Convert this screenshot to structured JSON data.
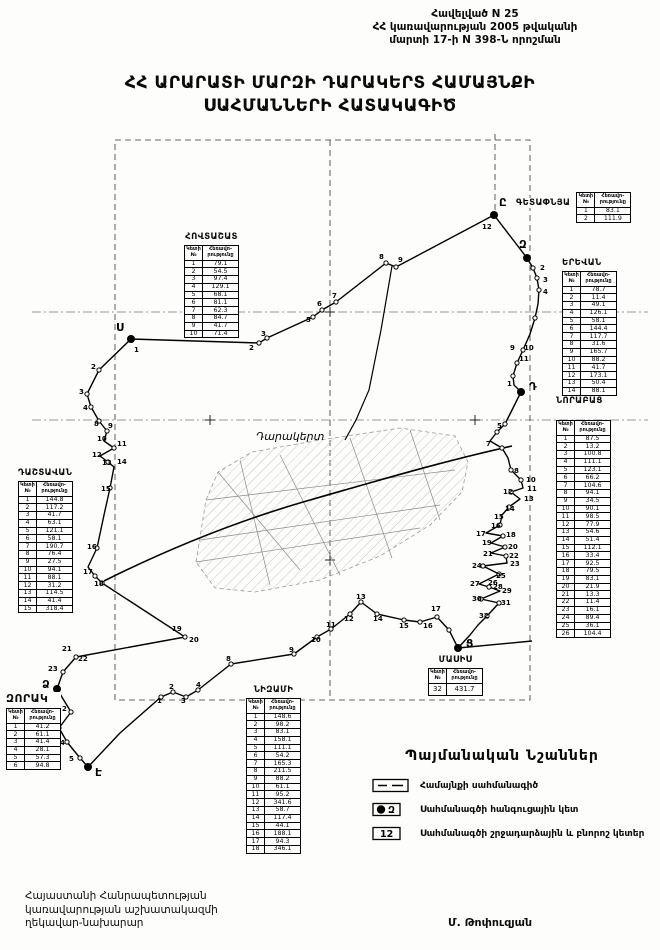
{
  "header": {
    "line1": "Հավելված N 25",
    "line2": "ՀՀ կառավարության 2005 թվականի",
    "line3": "մարտի 17-ի N 398-Ն որոշման"
  },
  "title": {
    "line1": "ՀՀ ԱՐԱՐԱՏԻ ՄԱՐԶԻ ԴԱՐԱԿԵՐՏ ՀԱՄԱՅՆՔԻ",
    "line2": "ՍԱՀՄԱՆՆԵՐԻ ՀԱՏԱԿԱԳԻԾ"
  },
  "map": {
    "settlement_label": "Դարակերտ",
    "junctions": [
      {
        "t": "Ս",
        "x": 131,
        "y": 339,
        "lx": 116,
        "ly": 331
      },
      {
        "t": "Ը",
        "x": 494,
        "y": 215,
        "lx": 499,
        "ly": 206
      },
      {
        "t": "Զ",
        "x": 527,
        "y": 258,
        "lx": 519,
        "ly": 248
      },
      {
        "t": "Դ",
        "x": 521,
        "y": 392,
        "lx": 529,
        "ly": 390
      },
      {
        "t": "Ց",
        "x": 458,
        "y": 648,
        "lx": 466,
        "ly": 647
      },
      {
        "t": "Ձ",
        "x": 57,
        "y": 689,
        "lx": 42,
        "ly": 688
      },
      {
        "t": "Է",
        "x": 88,
        "y": 767,
        "lx": 95,
        "ly": 776
      }
    ],
    "point_labels": [
      {
        "t": "2",
        "x": 249,
        "y": 350
      },
      {
        "t": "3",
        "x": 261,
        "y": 336
      },
      {
        "t": "5",
        "x": 306,
        "y": 322
      },
      {
        "t": "6",
        "x": 317,
        "y": 306
      },
      {
        "t": "7",
        "x": 332,
        "y": 298
      },
      {
        "t": "8",
        "x": 379,
        "y": 259
      },
      {
        "t": "9",
        "x": 398,
        "y": 262
      },
      {
        "t": "12",
        "x": 482,
        "y": 229
      },
      {
        "t": "2",
        "x": 540,
        "y": 270
      },
      {
        "t": "3",
        "x": 543,
        "y": 282
      },
      {
        "t": "4",
        "x": 543,
        "y": 294
      },
      {
        "t": "9",
        "x": 510,
        "y": 350
      },
      {
        "t": "10",
        "x": 524,
        "y": 350
      },
      {
        "t": "11",
        "x": 519,
        "y": 361
      },
      {
        "t": "1",
        "x": 507,
        "y": 386
      },
      {
        "t": "5",
        "x": 497,
        "y": 428
      },
      {
        "t": "7",
        "x": 486,
        "y": 446
      },
      {
        "t": "8",
        "x": 514,
        "y": 473
      },
      {
        "t": "10",
        "x": 526,
        "y": 482
      },
      {
        "t": "11",
        "x": 527,
        "y": 491
      },
      {
        "t": "12",
        "x": 503,
        "y": 494
      },
      {
        "t": "13",
        "x": 524,
        "y": 501
      },
      {
        "t": "14",
        "x": 505,
        "y": 511
      },
      {
        "t": "15",
        "x": 494,
        "y": 519
      },
      {
        "t": "16",
        "x": 491,
        "y": 528
      },
      {
        "t": "17",
        "x": 476,
        "y": 536
      },
      {
        "t": "18",
        "x": 506,
        "y": 537
      },
      {
        "t": "19",
        "x": 482,
        "y": 545
      },
      {
        "t": "20",
        "x": 508,
        "y": 549
      },
      {
        "t": "21",
        "x": 483,
        "y": 556
      },
      {
        "t": "22",
        "x": 509,
        "y": 558
      },
      {
        "t": "23",
        "x": 510,
        "y": 566
      },
      {
        "t": "24",
        "x": 472,
        "y": 568
      },
      {
        "t": "25",
        "x": 496,
        "y": 578
      },
      {
        "t": "26",
        "x": 488,
        "y": 585
      },
      {
        "t": "27",
        "x": 470,
        "y": 586
      },
      {
        "t": "28",
        "x": 493,
        "y": 589
      },
      {
        "t": "29",
        "x": 502,
        "y": 593
      },
      {
        "t": "30",
        "x": 472,
        "y": 601
      },
      {
        "t": "31",
        "x": 501,
        "y": 605
      },
      {
        "t": "32",
        "x": 479,
        "y": 618
      },
      {
        "t": "17",
        "x": 431,
        "y": 611
      },
      {
        "t": "16",
        "x": 423,
        "y": 628
      },
      {
        "t": "15",
        "x": 399,
        "y": 628
      },
      {
        "t": "14",
        "x": 373,
        "y": 621
      },
      {
        "t": "13",
        "x": 356,
        "y": 599
      },
      {
        "t": "12",
        "x": 344,
        "y": 621
      },
      {
        "t": "11",
        "x": 326,
        "y": 627
      },
      {
        "t": "10",
        "x": 311,
        "y": 642
      },
      {
        "t": "9",
        "x": 289,
        "y": 652
      },
      {
        "t": "8",
        "x": 226,
        "y": 661
      },
      {
        "t": "4",
        "x": 196,
        "y": 687
      },
      {
        "t": "3",
        "x": 181,
        "y": 703
      },
      {
        "t": "2",
        "x": 169,
        "y": 689
      },
      {
        "t": "1",
        "x": 157,
        "y": 703
      },
      {
        "t": "2",
        "x": 62,
        "y": 711
      },
      {
        "t": "3",
        "x": 51,
        "y": 728
      },
      {
        "t": "4",
        "x": 60,
        "y": 745
      },
      {
        "t": "5",
        "x": 69,
        "y": 761
      },
      {
        "t": "1",
        "x": 134,
        "y": 352
      },
      {
        "t": "2",
        "x": 91,
        "y": 369
      },
      {
        "t": "3",
        "x": 79,
        "y": 394
      },
      {
        "t": "4",
        "x": 83,
        "y": 410
      },
      {
        "t": "8",
        "x": 94,
        "y": 426
      },
      {
        "t": "9",
        "x": 108,
        "y": 428
      },
      {
        "t": "10",
        "x": 97,
        "y": 441
      },
      {
        "t": "11",
        "x": 117,
        "y": 446
      },
      {
        "t": "12",
        "x": 92,
        "y": 457
      },
      {
        "t": "13",
        "x": 102,
        "y": 465
      },
      {
        "t": "14",
        "x": 117,
        "y": 464
      },
      {
        "t": "15",
        "x": 101,
        "y": 491
      },
      {
        "t": "16",
        "x": 87,
        "y": 549
      },
      {
        "t": "17",
        "x": 83,
        "y": 574
      },
      {
        "t": "18",
        "x": 94,
        "y": 586
      },
      {
        "t": "19",
        "x": 172,
        "y": 631
      },
      {
        "t": "20",
        "x": 189,
        "y": 642
      },
      {
        "t": "21",
        "x": 62,
        "y": 651
      },
      {
        "t": "22",
        "x": 78,
        "y": 661
      },
      {
        "t": "23",
        "x": 48,
        "y": 671
      }
    ],
    "dots": [
      [
        259,
        343
      ],
      [
        267,
        338
      ],
      [
        313,
        317
      ],
      [
        322,
        310
      ],
      [
        336,
        302
      ],
      [
        386,
        263
      ],
      [
        396,
        267
      ],
      [
        533,
        268
      ],
      [
        537,
        278
      ],
      [
        539,
        290
      ],
      [
        535,
        318
      ],
      [
        523,
        350
      ],
      [
        517,
        363
      ],
      [
        513,
        376
      ],
      [
        505,
        424
      ],
      [
        497,
        432
      ],
      [
        502,
        448
      ],
      [
        511,
        470
      ],
      [
        521,
        480
      ],
      [
        511,
        492
      ],
      [
        509,
        507
      ],
      [
        500,
        525
      ],
      [
        503,
        536
      ],
      [
        505,
        547
      ],
      [
        506,
        556
      ],
      [
        483,
        566
      ],
      [
        499,
        574
      ],
      [
        489,
        587
      ],
      [
        481,
        599
      ],
      [
        499,
        603
      ],
      [
        487,
        616
      ],
      [
        449,
        630
      ],
      [
        437,
        617
      ],
      [
        420,
        622
      ],
      [
        404,
        620
      ],
      [
        377,
        614
      ],
      [
        361,
        602
      ],
      [
        350,
        614
      ],
      [
        331,
        629
      ],
      [
        317,
        637
      ],
      [
        294,
        654
      ],
      [
        231,
        664
      ],
      [
        198,
        690
      ],
      [
        186,
        697
      ],
      [
        173,
        692
      ],
      [
        161,
        697
      ],
      [
        80,
        758
      ],
      [
        67,
        742
      ],
      [
        59,
        728
      ],
      [
        71,
        712
      ],
      [
        99,
        370
      ],
      [
        87,
        394
      ],
      [
        91,
        407
      ],
      [
        99,
        421
      ],
      [
        107,
        431
      ],
      [
        114,
        448
      ],
      [
        108,
        462
      ],
      [
        110,
        488
      ],
      [
        97,
        548
      ],
      [
        95,
        576
      ],
      [
        102,
        583
      ],
      [
        185,
        637
      ],
      [
        76,
        657
      ],
      [
        63,
        672
      ]
    ]
  },
  "tables": {
    "hovtashat": {
      "caption": "ՀՈՎՏԱՇԱՏ",
      "col1": "Կետի №",
      "col2": "Հեռավո-րությունը",
      "rows": [
        [
          "1",
          "79.1"
        ],
        [
          "2",
          "54.5"
        ],
        [
          "3",
          "97.4"
        ],
        [
          "4",
          "129.1"
        ],
        [
          "5",
          "68.1"
        ],
        [
          "6",
          "81.1"
        ],
        [
          "7",
          "62.3"
        ],
        [
          "8",
          "84.7"
        ],
        [
          "9",
          "41.7"
        ],
        [
          "10",
          "71.4"
        ]
      ]
    },
    "getapnya": {
      "caption": "ԳԵՏԱՓՆՅԱ",
      "col1": "Կետի №",
      "col2": "Հեռավո-րությունը",
      "rows": [
        [
          "1",
          "83.1"
        ],
        [
          "2",
          "111.9"
        ]
      ]
    },
    "yerevan": {
      "caption": "ԵՐԵՎԱՆ",
      "col1": "Կետի №",
      "col2": "Հեռավո-րությունը",
      "rows": [
        [
          "1",
          "78.7"
        ],
        [
          "2",
          "11.4"
        ],
        [
          "3",
          "49.1"
        ],
        [
          "4",
          "126.1"
        ],
        [
          "5",
          "58.1"
        ],
        [
          "6",
          "144.4"
        ],
        [
          "7",
          "117.7"
        ],
        [
          "8",
          "31.6"
        ],
        [
          "9",
          "165.7"
        ],
        [
          "10",
          "88.2"
        ],
        [
          "11",
          "41.7"
        ],
        [
          "12",
          "173.1"
        ],
        [
          "13",
          "50.4"
        ],
        [
          "14",
          "88.1"
        ]
      ]
    },
    "norabats": {
      "caption": "ՆՈՐԱԲԱՑ",
      "col1": "Կետի №",
      "col2": "Հեռավո-րությունը",
      "rows": [
        [
          "1",
          "87.5"
        ],
        [
          "2",
          "13.2"
        ],
        [
          "3",
          "100.8"
        ],
        [
          "4",
          "111.1"
        ],
        [
          "5",
          "123.1"
        ],
        [
          "6",
          "66.2"
        ],
        [
          "7",
          "104.6"
        ],
        [
          "8",
          "94.1"
        ],
        [
          "9",
          "34.5"
        ],
        [
          "10",
          "90.1"
        ],
        [
          "11",
          "98.5"
        ],
        [
          "12",
          "77.9"
        ],
        [
          "13",
          "54.6"
        ],
        [
          "14",
          "51.4"
        ],
        [
          "15",
          "112.1"
        ],
        [
          "16",
          "33.4"
        ],
        [
          "17",
          "92.5"
        ],
        [
          "18",
          "79.5"
        ],
        [
          "19",
          "83.1"
        ],
        [
          "20",
          "21.9"
        ],
        [
          "21",
          "13.3"
        ],
        [
          "22",
          "11.4"
        ],
        [
          "23",
          "16.1"
        ],
        [
          "24",
          "89.4"
        ],
        [
          "25",
          "36.1"
        ],
        [
          "26",
          "104.4"
        ]
      ]
    },
    "dashtavan": {
      "caption": "ԴԱՇՏԱՎԱՆ",
      "col1": "Կետի №",
      "col2": "Հեռավո-րությունը",
      "rows": [
        [
          "1",
          "144.8"
        ],
        [
          "2",
          "117.2"
        ],
        [
          "3",
          "41.7"
        ],
        [
          "4",
          "63.1"
        ],
        [
          "5",
          "121.1"
        ],
        [
          "6",
          "58.1"
        ],
        [
          "7",
          "190.7"
        ],
        [
          "8",
          "76.4"
        ],
        [
          "9",
          "27.5"
        ],
        [
          "10",
          "94.1"
        ],
        [
          "11",
          "88.1"
        ],
        [
          "12",
          "31.2"
        ],
        [
          "13",
          "114.5"
        ],
        [
          "14",
          "41.4"
        ],
        [
          "15",
          "318.4"
        ]
      ]
    },
    "nizami": {
      "caption": "ՆԻԶԱՄԻ",
      "col1": "Կետի №",
      "col2": "Հեռավո-րությունը",
      "rows": [
        [
          "1",
          "148.6"
        ],
        [
          "2",
          "98.2"
        ],
        [
          "3",
          "83.1"
        ],
        [
          "4",
          "158.1"
        ],
        [
          "5",
          "111.1"
        ],
        [
          "6",
          "54.2"
        ],
        [
          "7",
          "165.3"
        ],
        [
          "8",
          "211.5"
        ],
        [
          "9",
          "88.2"
        ],
        [
          "10",
          "61.1"
        ],
        [
          "11",
          "95.2"
        ],
        [
          "12",
          "341.6"
        ],
        [
          "13",
          "58.7"
        ],
        [
          "14",
          "117.4"
        ],
        [
          "15",
          "44.1"
        ],
        [
          "16",
          "188.1"
        ],
        [
          "17",
          "94.3"
        ],
        [
          "18",
          "346.1"
        ]
      ]
    },
    "zorak": {
      "caption": "ԶՈՐԱԿ",
      "col1": "Կետի №",
      "col2": "Հեռավո-րությունը",
      "rows": [
        [
          "1",
          "41.2"
        ],
        [
          "2",
          "61.1"
        ],
        [
          "3",
          "41.4"
        ],
        [
          "4",
          "28.1"
        ],
        [
          "5",
          "57.3"
        ],
        [
          "6",
          "94.8"
        ]
      ]
    },
    "masis": {
      "caption": "ՄԱՍԻՍ",
      "col1": "Կետի №",
      "col2": "Հեռավո-րությունը",
      "rows": [
        [
          "32",
          "431.7"
        ]
      ]
    }
  },
  "legend": {
    "title": "Պայմանական Նշաններ",
    "items": [
      {
        "label": "Համայնքի սահմանագիծ"
      },
      {
        "label": "Սահմանագծի հանգուցային կետ",
        "symbol_letter": "Զ"
      },
      {
        "label": "Սահմանագծի շրջադարձային և բնորոշ կետեր",
        "symbol_text": "12"
      }
    ]
  },
  "footer": {
    "line1": "Հայաստանի Հանրապետության",
    "line2": "կառավարության աշխատակազմի",
    "line3": "ղեկավար-նախարար"
  },
  "signature": "Մ. Թոփուզյան"
}
